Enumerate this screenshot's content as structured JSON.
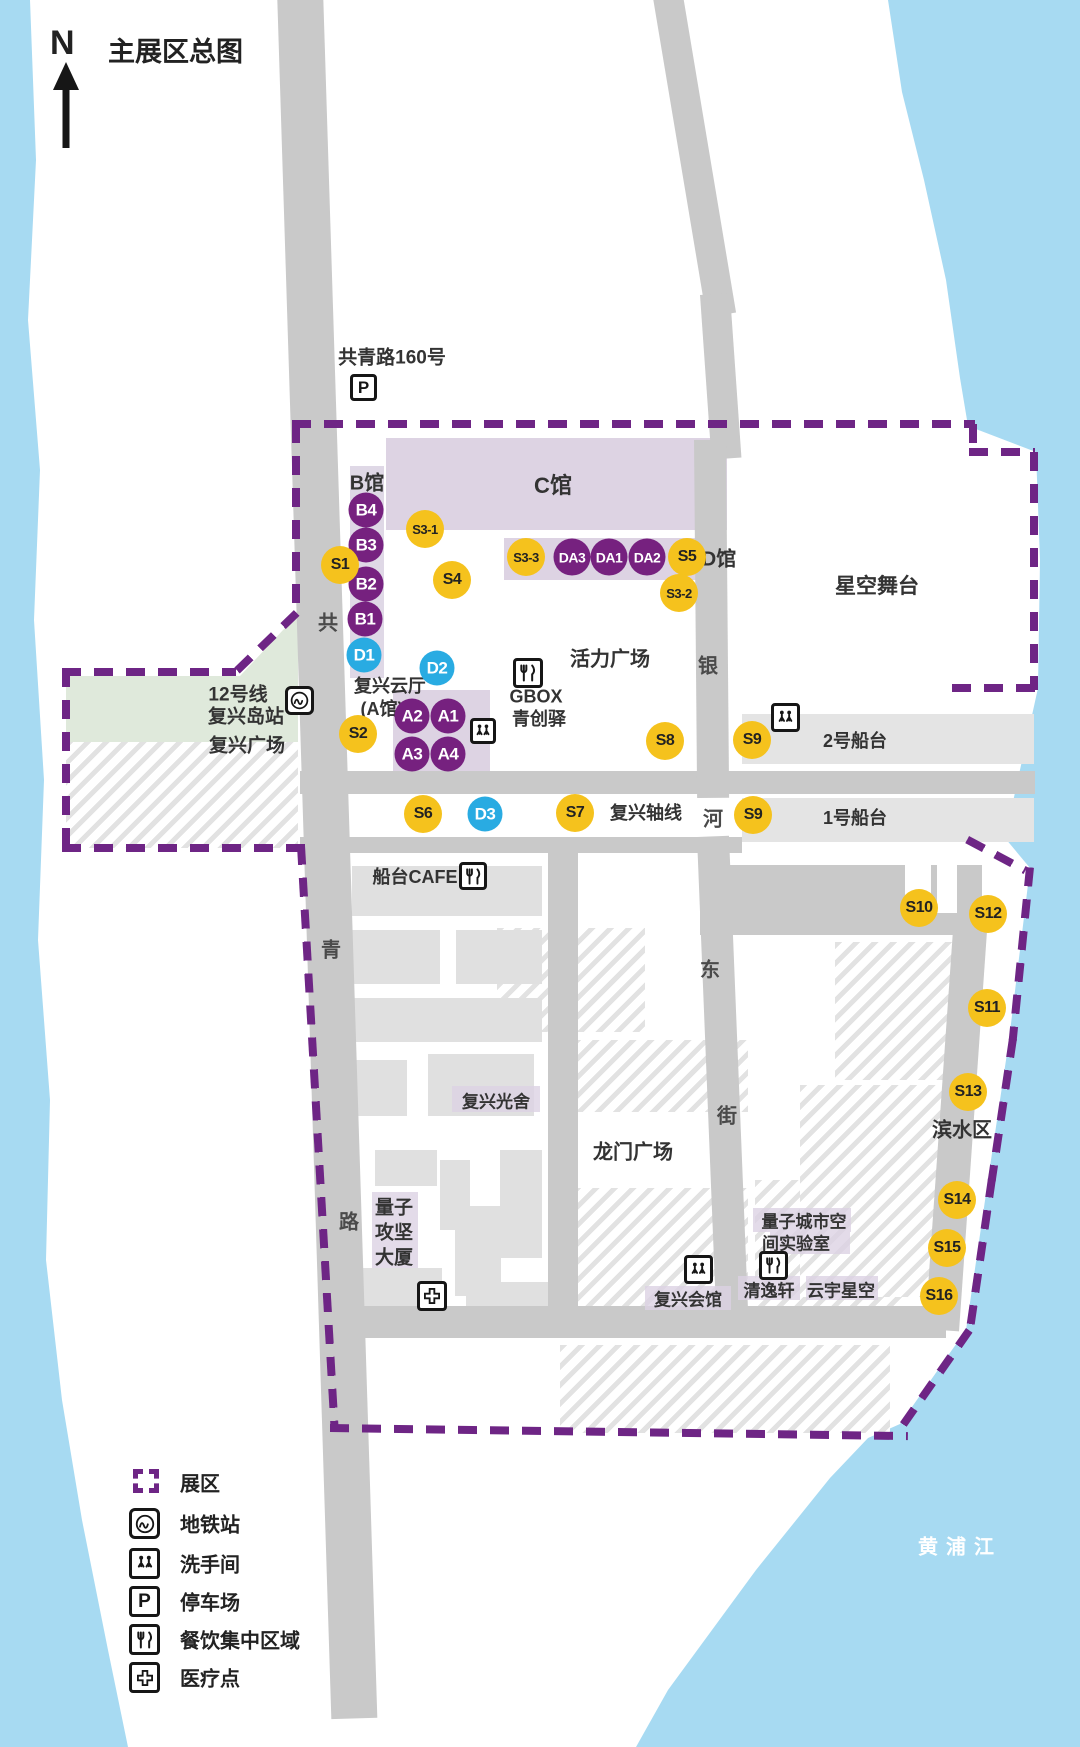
{
  "title": "主展区总图",
  "compass": {
    "label": "N"
  },
  "address": {
    "text": "共青路160号"
  },
  "metro_area": {
    "line": "12号线",
    "station": "复兴岛站",
    "plaza": "复兴广场"
  },
  "streets": {
    "gong": "共",
    "qing": "青",
    "lu": "路",
    "yin": "银",
    "he": "河",
    "dong": "东",
    "jie": "街"
  },
  "river": {
    "name": "黄浦江"
  },
  "venues": {
    "hall_b": "B馆",
    "hall_c": "C馆",
    "hall_d": "D馆",
    "cloud_hall": "复兴云厅",
    "cloud_hall_sub": "(A馆)",
    "star_stage": "星空舞台",
    "vitality_plaza": "活力广场",
    "gbox": "GBOX",
    "gbox_sub": "青创驿",
    "shipway_2": "2号船台",
    "shipway_1": "1号船台",
    "fuxing_axis": "复兴轴线",
    "cafe": "船台CAFE",
    "light_house": "复兴光舍",
    "longmen_plaza": "龙门广场",
    "waterfront": "滨水区",
    "quantum_tower_1": "量子",
    "quantum_tower_2": "攻坚",
    "quantum_tower_3": "大厦",
    "quantum_lab_1": "量子城市空",
    "quantum_lab_2": "间实验室",
    "qingyi_xuan": "清逸轩",
    "yunyu_star": "云宇星空",
    "fuxing_hall": "复兴会馆"
  },
  "markers": {
    "purple": [
      "B4",
      "B3",
      "B2",
      "B1",
      "A2",
      "A1",
      "A3",
      "A4"
    ],
    "da": [
      "DA3",
      "DA1",
      "DA2"
    ],
    "blue": [
      "D1",
      "D2",
      "D3"
    ],
    "yellow": [
      "S1",
      "S3-1",
      "S4",
      "S2",
      "S3-3",
      "S5",
      "S3-2",
      "S6",
      "S7",
      "S8",
      "S9",
      "S9",
      "S10",
      "S11",
      "S12",
      "S13",
      "S14",
      "S15",
      "S16"
    ]
  },
  "icons": {
    "parking_letter": "P"
  },
  "legend": {
    "items": [
      {
        "icon": "exhibition-area-icon",
        "label": "展区"
      },
      {
        "icon": "metro-icon",
        "label": "地铁站"
      },
      {
        "icon": "restroom-icon",
        "label": "洗手间"
      },
      {
        "icon": "parking-icon",
        "label": "停车场"
      },
      {
        "icon": "dining-icon",
        "label": "餐饮集中区域"
      },
      {
        "icon": "medical-icon",
        "label": "医疗点"
      }
    ]
  },
  "colors": {
    "water": "#A7DAF2",
    "road": "#C9C9C9",
    "building": "#E0E0E0",
    "hall_fill": "#DDD3E3",
    "green": "#DFE9DB",
    "boundary": "#6E2585",
    "marker_yellow": "#F5C21D",
    "marker_purple": "#76217F",
    "marker_blue": "#29ABE2"
  }
}
